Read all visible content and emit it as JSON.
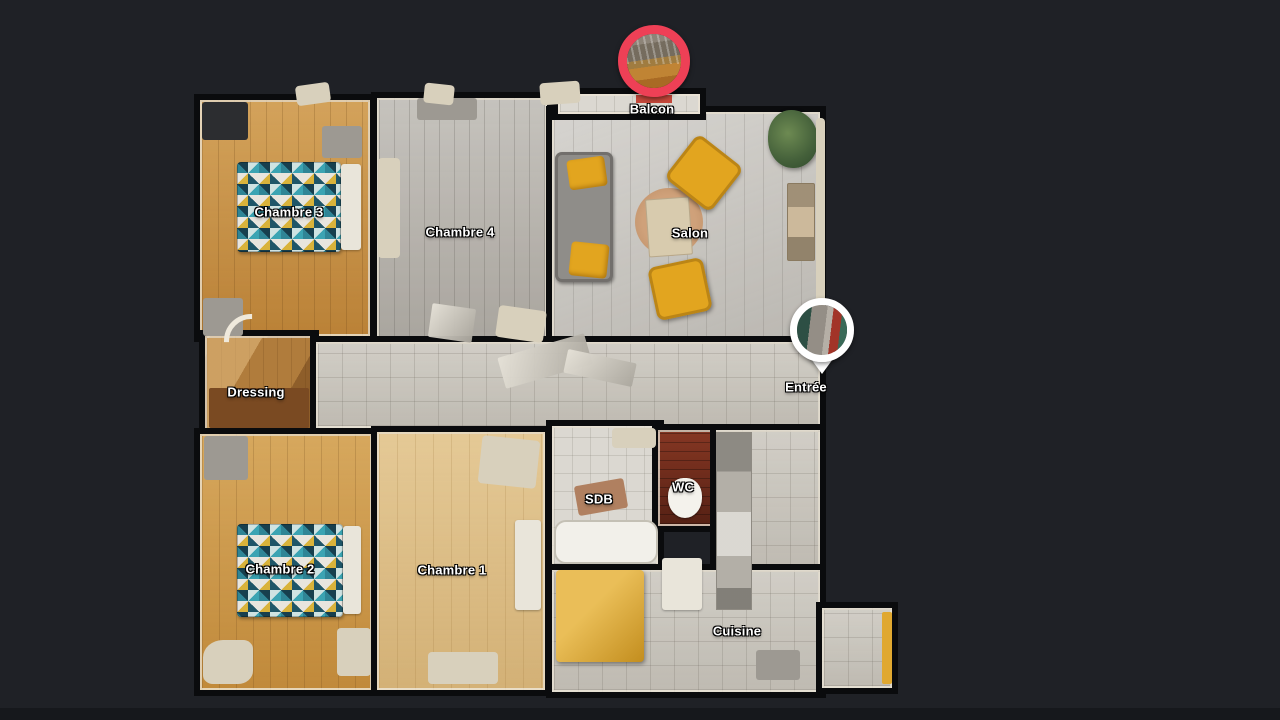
{
  "view": {
    "name": "Apartment floor plan view",
    "background_color": "#1f2126"
  },
  "floorplan": {
    "rooms": [
      {
        "key": "chambre-3",
        "label": "Chambre 3"
      },
      {
        "key": "chambre-4",
        "label": "Chambre 4"
      },
      {
        "key": "salon",
        "label": "Salon"
      },
      {
        "key": "dressing",
        "label": "Dressing"
      },
      {
        "key": "chambre-2",
        "label": "Chambre 2"
      },
      {
        "key": "chambre-1",
        "label": "Chambre 1"
      },
      {
        "key": "sdb",
        "label": "SDB"
      },
      {
        "key": "wc",
        "label": "WC"
      },
      {
        "key": "cuisine",
        "label": "Cuisine"
      }
    ],
    "markers": [
      {
        "key": "balcon",
        "label": "Balcon",
        "shape": "circle-photo",
        "ring_color": "#ee4056",
        "photo": "balcony-view"
      },
      {
        "key": "entree",
        "label": "Entrée",
        "shape": "pin-photo",
        "ring_color": "#ffffff",
        "photo": "entry-hallway-view"
      }
    ]
  },
  "colors": {
    "bg": "#1f2126",
    "wall_gap": "#0a0b0d",
    "marker_red": "#ee4056",
    "furniture_yellow": "#e2a51f",
    "bed_teal": "#3ba4b3"
  }
}
